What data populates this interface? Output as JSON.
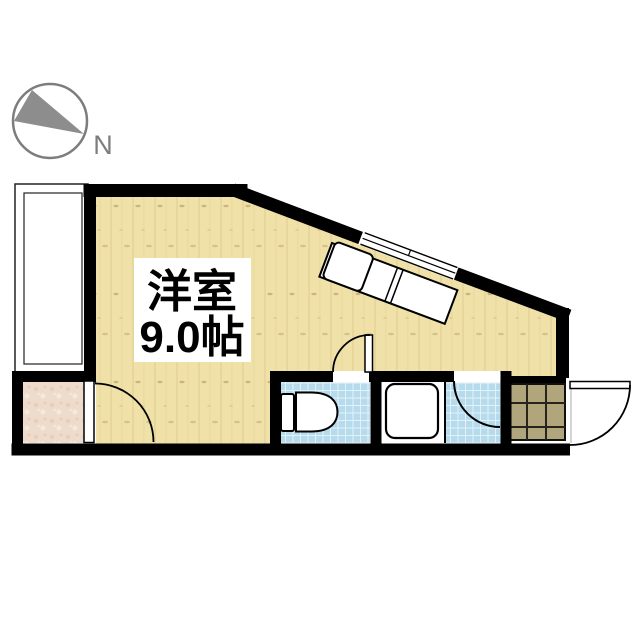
{
  "compass": {
    "label": "N"
  },
  "room": {
    "name": "洋室",
    "size": "9.0帖"
  },
  "colors": {
    "bg": "#ffffff",
    "wall": "#000000",
    "wood": "#f0e1a8",
    "woodGrain": "#e2d194",
    "woodKnot": "#cdb67c",
    "tile": "#b6dbec",
    "tileGrid": "#e8f4fa",
    "stone": "#eedbcb",
    "stoneSpot": "#dfc2a8",
    "genkan": "#b1a57b",
    "genkanGrid": "#26241c",
    "compass": "#7d7d7d",
    "needle": "#8d8d8d",
    "text": "#000000",
    "fixture": "#ffffff"
  }
}
